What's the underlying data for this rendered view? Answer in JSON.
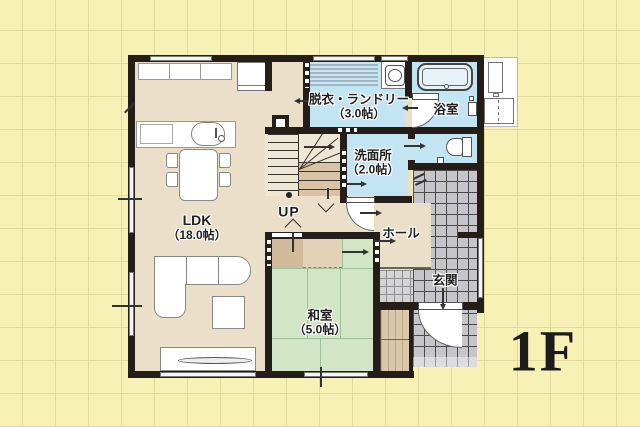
{
  "floor_plan": {
    "floor_label": "1F",
    "stairs_label": "UP",
    "rooms": {
      "ldk": {
        "name": "LDK",
        "size": "（18.0帖）"
      },
      "washitsu": {
        "name": "和室",
        "size": "（5.0帖）"
      },
      "laundry": {
        "name": "脱衣・ランドリー",
        "size": "（3.0帖）"
      },
      "washroom": {
        "name": "洗面所",
        "size": "（2.0帖）"
      },
      "bathroom": {
        "name": "浴室"
      },
      "hall": {
        "name": "ホール"
      },
      "entrance": {
        "name": "玄関"
      }
    },
    "colors": {
      "background": "#f7f1b6",
      "grid_line": "#e2da9b",
      "wall": "#241d18",
      "floor_beige": "#ebdfc9",
      "tatami_green": "#d2e6c5",
      "wet_area_blue": "#c3e4f2",
      "tile_gray": "#c6c6ca",
      "closet_tan": "#d2bb9c",
      "text": "#1f1f1f"
    }
  }
}
